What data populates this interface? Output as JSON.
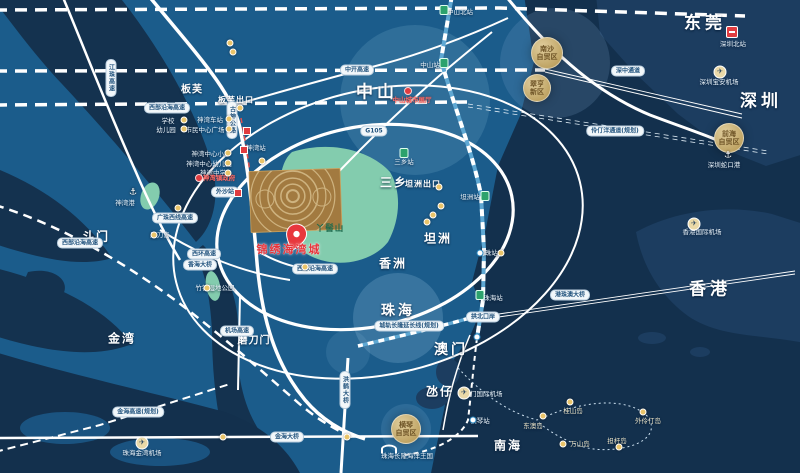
{
  "colors": {
    "land": "#1b5c8b",
    "deep_water": "#13304d",
    "far_shore": "#1c3d60",
    "river": "#14324f",
    "road": "#ffffff",
    "rail_blue": "#5fa8d3",
    "hill_green": "#83ccae",
    "project_brown": "#a27a40",
    "gold": "#d8b96a",
    "red": "#e03c40",
    "pill_text": "#24557f"
  },
  "map": {
    "labels": [
      {
        "t": "东莞",
        "x": 705,
        "y": 21,
        "k": "xl",
        "n": "region-dongguan"
      },
      {
        "t": "深圳",
        "x": 761,
        "y": 99,
        "k": "xl",
        "n": "region-shenzhen"
      },
      {
        "t": "香港",
        "x": 710,
        "y": 287,
        "k": "xl",
        "n": "region-hongkong"
      },
      {
        "t": "中山",
        "x": 377,
        "y": 90,
        "k": "xl",
        "n": "region-zhongshan"
      },
      {
        "t": "珠海",
        "x": 398,
        "y": 310,
        "k": "xl2",
        "n": "region-zhuhai"
      },
      {
        "t": "澳门",
        "x": 451,
        "y": 349,
        "k": "xl2",
        "n": "region-macau"
      },
      {
        "t": "斗门",
        "x": 96,
        "y": 236,
        "k": "lg",
        "n": "region-doumen"
      },
      {
        "t": "金湾",
        "x": 122,
        "y": 338,
        "k": "lg",
        "n": "region-jinwan"
      },
      {
        "t": "南海",
        "x": 508,
        "y": 445,
        "k": "lg",
        "n": "region-nanhai"
      },
      {
        "t": "三乡",
        "x": 394,
        "y": 182,
        "k": "lg",
        "n": "region-sanxiang"
      },
      {
        "t": "坦洲",
        "x": 438,
        "y": 238,
        "k": "lg",
        "n": "region-tanzhou"
      },
      {
        "t": "香洲",
        "x": 393,
        "y": 263,
        "k": "lg",
        "n": "region-xiangzhou"
      },
      {
        "t": "氹仔",
        "x": 440,
        "y": 391,
        "k": "lg",
        "n": "region-dangzai"
      },
      {
        "t": "板芙",
        "x": 192,
        "y": 88,
        "k": "md",
        "n": "region-banfu"
      },
      {
        "t": "磨刀门",
        "x": 254,
        "y": 339,
        "k": "md",
        "n": "region-modaomen"
      },
      {
        "t": "板芙出口",
        "x": 236,
        "y": 100,
        "k": "exit",
        "n": "exit-banfu"
      },
      {
        "t": "坦洲出口",
        "x": 423,
        "y": 184,
        "k": "exit",
        "n": "exit-tanzhou"
      },
      {
        "t": "西部沿海高速",
        "x": 167,
        "y": 108,
        "k": "pill",
        "n": "road-xibuyanhai"
      },
      {
        "t": "古神公路",
        "x": 232,
        "y": 120,
        "k": "pillv",
        "n": "road-gushen"
      },
      {
        "t": "江珠高速",
        "x": 111,
        "y": 78,
        "k": "pillv",
        "n": "road-jiangzhu"
      },
      {
        "t": "广珠西线高速",
        "x": 175,
        "y": 218,
        "k": "pill",
        "n": "road-guangzhuxixian"
      },
      {
        "t": "西部沿海高速",
        "x": 80,
        "y": 243,
        "k": "pill",
        "n": "road-xibuyanhai-2"
      },
      {
        "t": "西环高速",
        "x": 204,
        "y": 254,
        "k": "pill",
        "n": "road-xihuan"
      },
      {
        "t": "香海大桥",
        "x": 200,
        "y": 265,
        "k": "pill",
        "n": "road-xianghai-bridge"
      },
      {
        "t": "机场高速",
        "x": 237,
        "y": 331,
        "k": "pill",
        "n": "road-jichang"
      },
      {
        "t": "金海大桥",
        "x": 287,
        "y": 437,
        "k": "pill",
        "n": "road-jinhai-bridge"
      },
      {
        "t": "金海高速(规划)",
        "x": 138,
        "y": 412,
        "k": "pill",
        "n": "road-jinhai-planned"
      },
      {
        "t": "洪鹤大桥",
        "x": 345,
        "y": 390,
        "k": "pillv",
        "n": "road-honghe-bridge"
      },
      {
        "t": "西部沿海高速",
        "x": 315,
        "y": 269,
        "k": "pill",
        "n": "road-xibuyanhai-3"
      },
      {
        "t": "中开高速",
        "x": 357,
        "y": 70,
        "k": "pill",
        "n": "road-zhongkai"
      },
      {
        "t": "G105",
        "x": 374,
        "y": 131,
        "k": "pill",
        "n": "road-g105"
      },
      {
        "t": "深中通道",
        "x": 628,
        "y": 71,
        "k": "pill",
        "n": "road-shenzhong-link"
      },
      {
        "t": "伶仃洋通道(规划)",
        "x": 615,
        "y": 131,
        "k": "pill",
        "n": "road-lingdingyang"
      },
      {
        "t": "港珠澳大桥",
        "x": 570,
        "y": 295,
        "k": "pill",
        "n": "road-hzmb"
      },
      {
        "t": "城轨长隆延长线(规划)",
        "x": 409,
        "y": 326,
        "k": "pill",
        "n": "rail-changlong-ext"
      },
      {
        "t": "拱北口岸",
        "x": 483,
        "y": 317,
        "k": "pill",
        "n": "gongbei-port"
      },
      {
        "t": "外沙站",
        "x": 225,
        "y": 192,
        "k": "pill",
        "n": "station-waisha"
      },
      {
        "t": "学校",
        "x": 168,
        "y": 120,
        "k": "poi",
        "n": "poi-school"
      },
      {
        "t": "幼儿园",
        "x": 166,
        "y": 129,
        "k": "poi",
        "n": "poi-kindergarten"
      },
      {
        "t": "神湾车站",
        "x": 210,
        "y": 119,
        "k": "poi",
        "n": "poi-shenwan-bus"
      },
      {
        "t": "市民中心广场",
        "x": 205,
        "y": 129,
        "k": "poi",
        "n": "poi-civic-plaza"
      },
      {
        "t": "神湾中心小学",
        "x": 211,
        "y": 153,
        "k": "poi",
        "n": "poi-shenwan-primary"
      },
      {
        "t": "神湾中心幼儿园",
        "x": 209,
        "y": 163,
        "k": "poi",
        "n": "poi-shenwan-kindergarten"
      },
      {
        "t": "神湾中学",
        "x": 213,
        "y": 172,
        "k": "poi",
        "n": "poi-shenwan-middle"
      },
      {
        "t": "神湾站",
        "x": 256,
        "y": 147,
        "k": "poi",
        "n": "station-shenwan"
      },
      {
        "t": "磨刀岛",
        "x": 160,
        "y": 234,
        "k": "poi",
        "n": "poi-modao-island"
      },
      {
        "t": "竹银湿地公园",
        "x": 215,
        "y": 287,
        "k": "poi",
        "n": "poi-zhuyin-park"
      },
      {
        "t": "神湾港",
        "x": 125,
        "y": 202,
        "k": "poi",
        "n": "poi-shenwan-port"
      },
      {
        "t": "珠海金湾机场",
        "x": 142,
        "y": 452,
        "k": "poi",
        "n": "poi-jinwan-airport"
      },
      {
        "t": "澳门国际机场",
        "x": 483,
        "y": 393,
        "k": "poi",
        "n": "poi-macau-airport"
      },
      {
        "t": "珠海长隆海洋王国",
        "x": 407,
        "y": 455,
        "k": "poi",
        "n": "poi-chimelong"
      },
      {
        "t": "香港国际机场",
        "x": 702,
        "y": 231,
        "k": "poi",
        "n": "poi-hk-airport"
      },
      {
        "t": "深圳宝安机场",
        "x": 719,
        "y": 81,
        "k": "poi",
        "n": "poi-baoan-airport"
      },
      {
        "t": "深圳蛇口港",
        "x": 724,
        "y": 164,
        "k": "poi",
        "n": "poi-shekou-port"
      },
      {
        "t": "深圳北站",
        "x": 733,
        "y": 43,
        "k": "poi",
        "n": "station-shenzhenbei"
      },
      {
        "t": "明珠站",
        "x": 488,
        "y": 252,
        "k": "poi",
        "n": "station-mingzhu"
      },
      {
        "t": "坦洲站",
        "x": 470,
        "y": 196,
        "k": "poi",
        "n": "station-tanzhou"
      },
      {
        "t": "三乡站",
        "x": 404,
        "y": 161,
        "k": "poi",
        "n": "station-sanxiang"
      },
      {
        "t": "中山站",
        "x": 430,
        "y": 64,
        "k": "poi",
        "n": "station-zhongshan"
      },
      {
        "t": "中山北站",
        "x": 460,
        "y": 11,
        "k": "poi",
        "n": "station-zhongshanbei"
      },
      {
        "t": "珠海站",
        "x": 493,
        "y": 297,
        "k": "poi",
        "n": "station-zhuhai"
      },
      {
        "t": "横琴站",
        "x": 480,
        "y": 420,
        "k": "poi",
        "n": "station-hengqin"
      },
      {
        "t": "东澳岛",
        "x": 533,
        "y": 425,
        "k": "island",
        "n": "island-dongao"
      },
      {
        "t": "桂山岛",
        "x": 573,
        "y": 410,
        "k": "island",
        "n": "island-guishan"
      },
      {
        "t": "外伶仃岛",
        "x": 648,
        "y": 420,
        "k": "island",
        "n": "island-wailingding"
      },
      {
        "t": "万山岛",
        "x": 580,
        "y": 443,
        "k": "island",
        "n": "island-wanshan"
      },
      {
        "t": "担杆岛",
        "x": 617,
        "y": 440,
        "k": "island",
        "n": "island-dangan"
      },
      {
        "t": "中山城市展厅",
        "x": 412,
        "y": 99,
        "k": "red",
        "n": "red-poi-zhongshan-hall"
      },
      {
        "t": "神湾镇政府",
        "x": 219,
        "y": 177,
        "k": "red",
        "n": "red-poi-shenwan-gov"
      },
      {
        "t": "锦绣海湾城",
        "x": 289,
        "y": 249,
        "k": "project",
        "n": "project-name"
      },
      {
        "t": "丫髻山",
        "x": 330,
        "y": 228,
        "k": "mtn",
        "n": "mountain-yajishan"
      }
    ],
    "zones": [
      {
        "lines": [
          "南沙",
          "自贸区"
        ],
        "x": 547,
        "y": 53,
        "r": 15,
        "n": "zone-nansha"
      },
      {
        "lines": [
          "翠亨",
          "新区"
        ],
        "x": 537,
        "y": 88,
        "r": 13,
        "n": "zone-cuiheng"
      },
      {
        "lines": [
          "前海",
          "自贸区"
        ],
        "x": 729,
        "y": 138,
        "r": 14,
        "n": "zone-qianhai"
      },
      {
        "lines": [
          "横琴",
          "自贸区"
        ],
        "x": 406,
        "y": 429,
        "r": 14,
        "n": "zone-hengqin"
      }
    ],
    "markers": [
      {
        "k": "gold",
        "x": 184,
        "y": 120
      },
      {
        "k": "gold",
        "x": 184,
        "y": 129
      },
      {
        "k": "gold",
        "x": 229,
        "y": 119
      },
      {
        "k": "gold",
        "x": 229,
        "y": 129
      },
      {
        "k": "gold",
        "x": 228,
        "y": 153
      },
      {
        "k": "gold",
        "x": 228,
        "y": 163
      },
      {
        "k": "gold",
        "x": 228,
        "y": 173
      },
      {
        "k": "gold",
        "x": 240,
        "y": 108
      },
      {
        "k": "gold",
        "x": 439,
        "y": 187
      },
      {
        "k": "gold",
        "x": 178,
        "y": 208
      },
      {
        "k": "gold",
        "x": 154,
        "y": 235
      },
      {
        "k": "gold",
        "x": 207,
        "y": 288
      },
      {
        "k": "gold",
        "x": 223,
        "y": 437
      },
      {
        "k": "gold",
        "x": 347,
        "y": 437
      },
      {
        "k": "gold",
        "x": 441,
        "y": 206
      },
      {
        "k": "gold",
        "x": 433,
        "y": 215
      },
      {
        "k": "gold",
        "x": 427,
        "y": 222
      },
      {
        "k": "gold",
        "x": 501,
        "y": 253
      },
      {
        "k": "gold",
        "x": 543,
        "y": 416
      },
      {
        "k": "gold",
        "x": 570,
        "y": 402
      },
      {
        "k": "gold",
        "x": 643,
        "y": 412
      },
      {
        "k": "gold",
        "x": 563,
        "y": 444
      },
      {
        "k": "gold",
        "x": 619,
        "y": 447
      },
      {
        "k": "gold",
        "x": 230,
        "y": 43
      },
      {
        "k": "gold",
        "x": 233,
        "y": 52
      },
      {
        "k": "gold",
        "x": 305,
        "y": 267
      },
      {
        "k": "gold",
        "x": 262,
        "y": 161
      },
      {
        "k": "green",
        "x": 444,
        "y": 63
      },
      {
        "k": "green",
        "x": 404,
        "y": 153
      },
      {
        "k": "green",
        "x": 485,
        "y": 196
      },
      {
        "k": "green",
        "x": 480,
        "y": 295
      },
      {
        "k": "green",
        "x": 444,
        "y": 10
      },
      {
        "k": "rail",
        "x": 480,
        "y": 253
      },
      {
        "k": "rail",
        "x": 477,
        "y": 337
      },
      {
        "k": "rail",
        "x": 473,
        "y": 420
      },
      {
        "k": "redsq",
        "x": 244,
        "y": 150
      },
      {
        "k": "redsq",
        "x": 238,
        "y": 193
      },
      {
        "k": "redsq",
        "x": 247,
        "y": 131
      },
      {
        "k": "reddot",
        "x": 408,
        "y": 91
      },
      {
        "k": "reddot",
        "x": 199,
        "y": 178
      },
      {
        "k": "train",
        "x": 732,
        "y": 32
      },
      {
        "k": "plane",
        "x": 142,
        "y": 443,
        "c": "✈"
      },
      {
        "k": "plane",
        "x": 464,
        "y": 393,
        "c": "✈"
      },
      {
        "k": "plane",
        "x": 720,
        "y": 72,
        "c": "✈"
      },
      {
        "k": "plane",
        "x": 694,
        "y": 224,
        "c": "✈"
      },
      {
        "k": "anchor",
        "x": 728,
        "y": 156,
        "c": "⚓"
      },
      {
        "k": "anchor",
        "x": 133,
        "y": 193,
        "c": "⚓"
      },
      {
        "k": "dolphin",
        "x": 389,
        "y": 449
      }
    ]
  }
}
